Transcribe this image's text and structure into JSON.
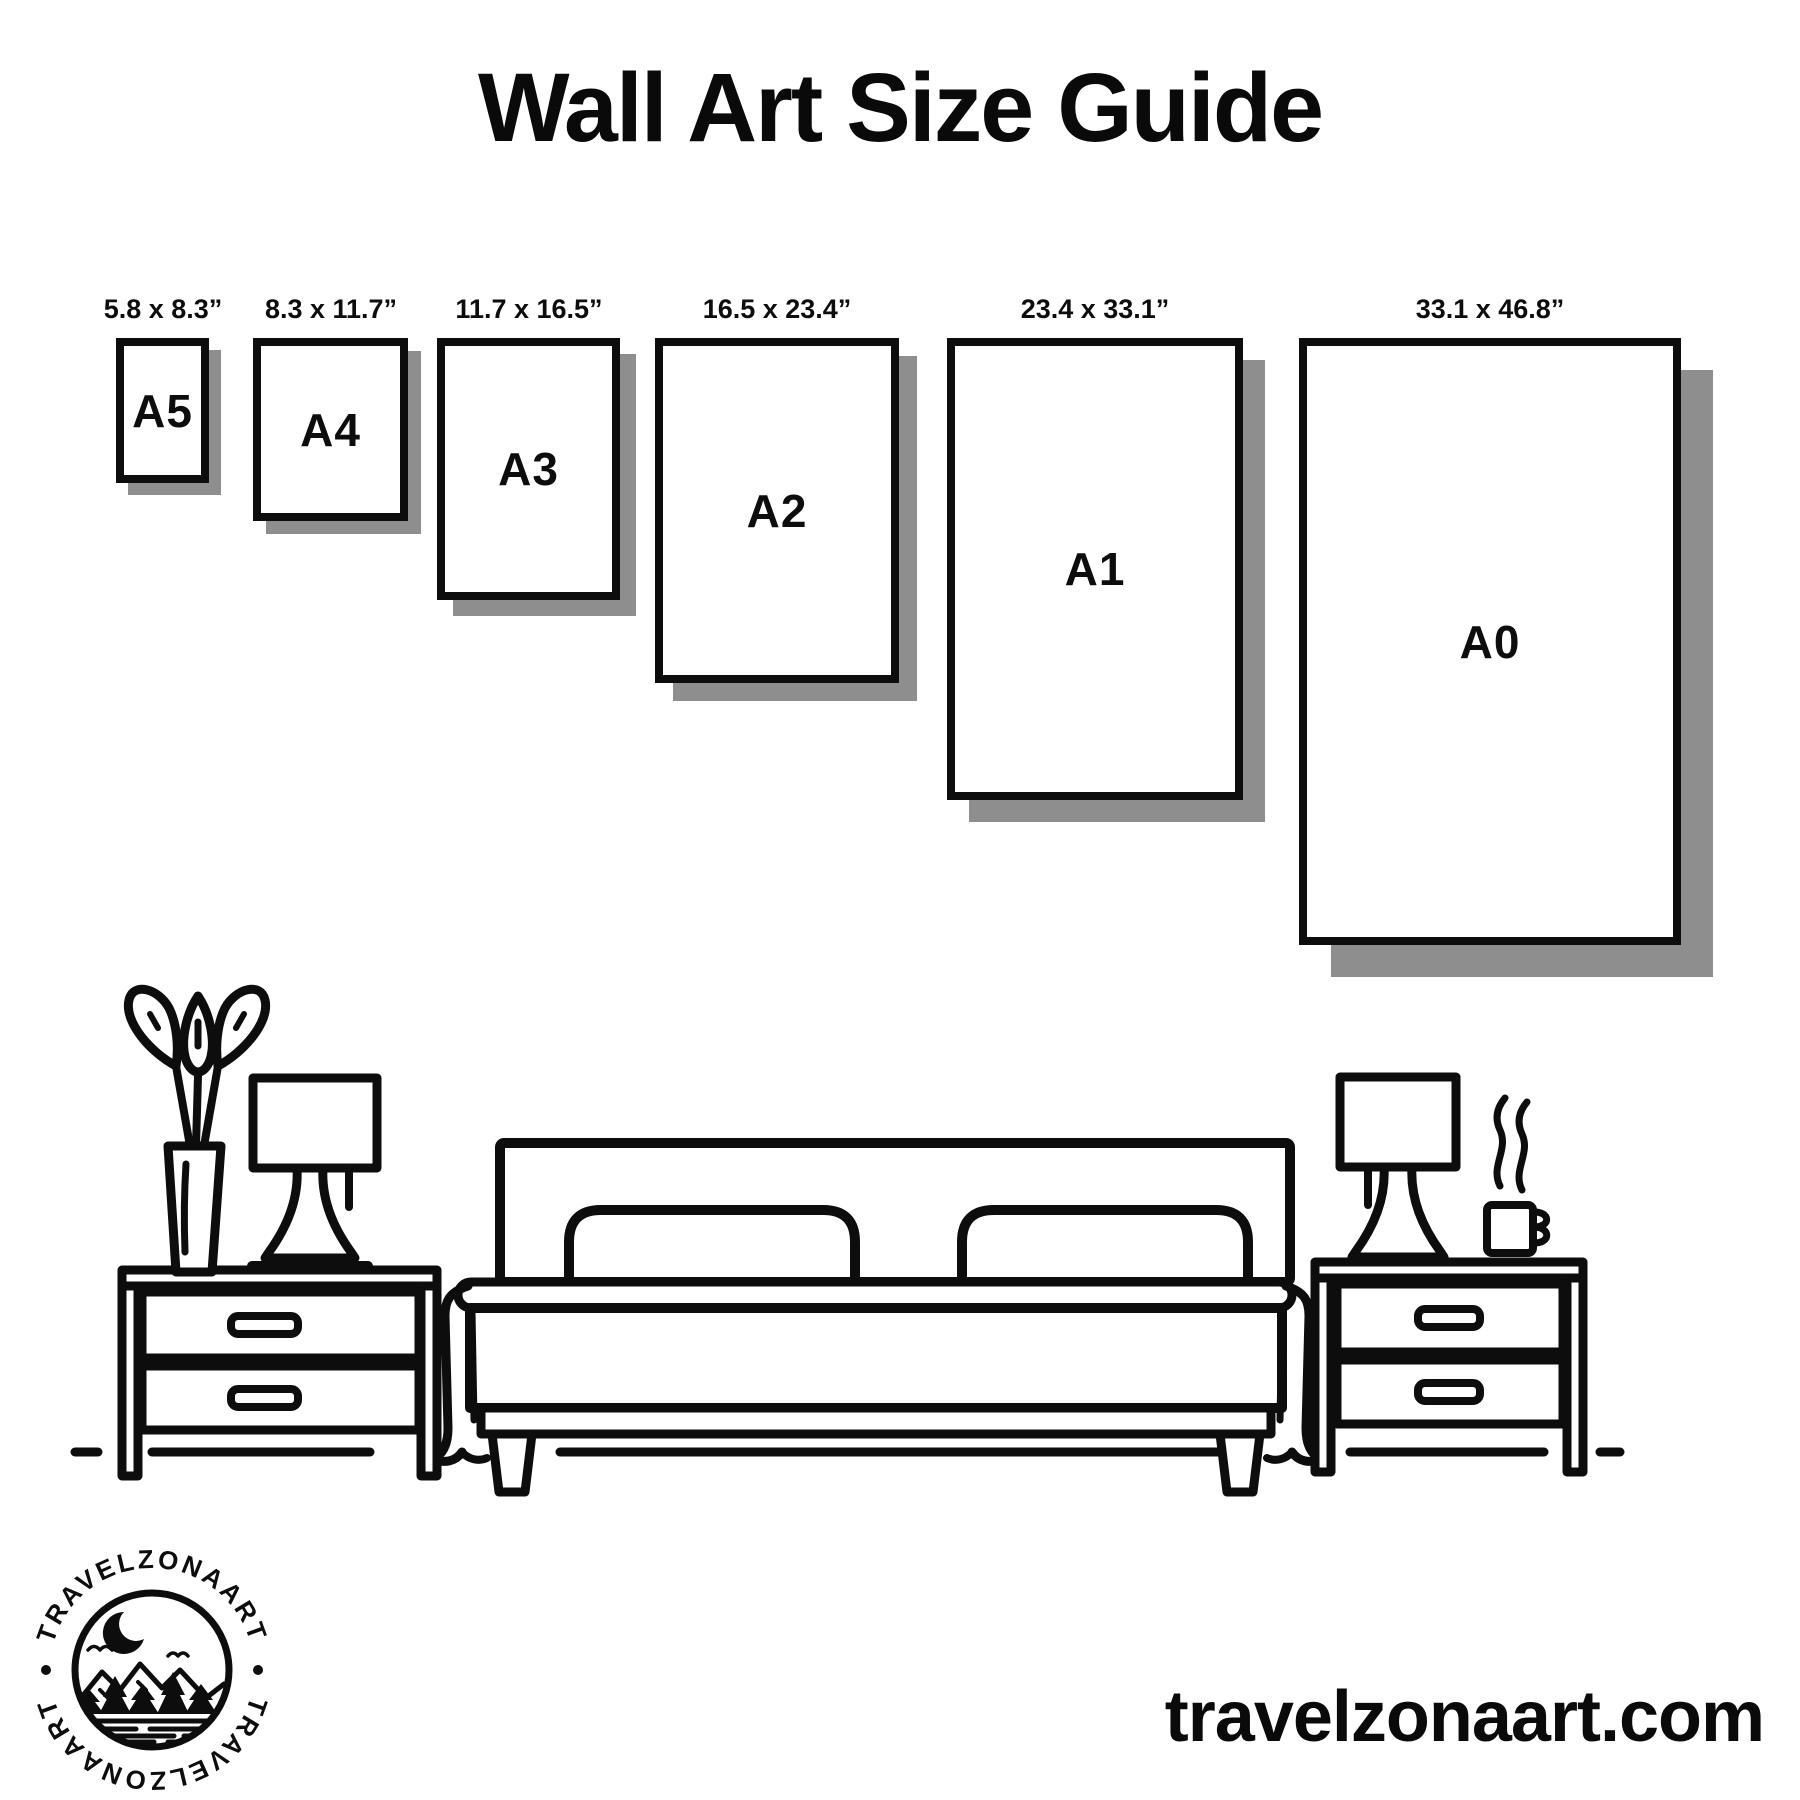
{
  "header": {
    "title": "Wall Art Size Guide"
  },
  "sizes": [
    {
      "name": "A5",
      "dims": "5.8 x 8.3”"
    },
    {
      "name": "A4",
      "dims": "8.3 x 11.7”"
    },
    {
      "name": "A3",
      "dims": "11.7 x 16.5”"
    },
    {
      "name": "A2",
      "dims": "16.5 x 23.4”"
    },
    {
      "name": "A1",
      "dims": "23.4 x 33.1”"
    },
    {
      "name": "A0",
      "dims": "33.1 x 46.8”"
    }
  ],
  "logo": {
    "badge_text_top": "TRAVELZONAART",
    "badge_text_bottom": "TRAVELZONAART"
  },
  "footer": {
    "website": "travelzonaart.com"
  },
  "colors": {
    "ink": "#0d0d0d",
    "shadow": "#8e8e8e",
    "background": "#ffffff"
  }
}
